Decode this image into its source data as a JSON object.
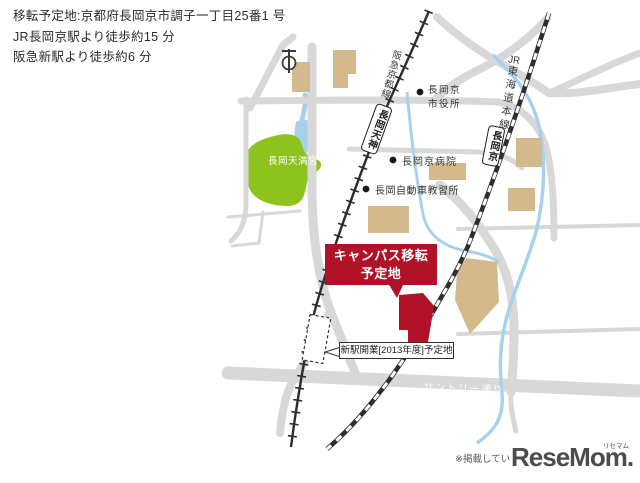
{
  "header": {
    "line1": "移転予定地:京都府長岡京市調子一丁目25番1 号",
    "line2": "JR長岡京駅より徒歩約15 分",
    "line3": "阪急新駅より徒歩約6 分"
  },
  "map": {
    "hankyu_line_label": "阪急京都線",
    "jr_line_label": {
      "prefix": "JR",
      "rest": "東海道本線"
    },
    "stations": {
      "hankyu": "長岡天神",
      "jr": "長岡京"
    },
    "park_label": "長岡天満宮",
    "city_hall": {
      "line1": "長岡京",
      "line2": "市役所"
    },
    "hospital_label": "長岡京病院",
    "driving_school_label": "長岡自動車教習所",
    "callout": {
      "line1": "キャンパス移転",
      "line2": "予定地"
    },
    "new_station_label": "新駅開業[2013年度]予定地",
    "road_label": "サントリー通り"
  },
  "footer": {
    "note": "※掲載してい",
    "logo_text": "ReseMom.",
    "logo_ruby": "リセマム"
  },
  "colors": {
    "site_red": "#b01229",
    "park_green": "#8ec31f",
    "building_beige": "#d4b98c",
    "road_gray": "#d8d8d8",
    "water_blue": "#a8d1ee",
    "rail_black": "#2d2d2d"
  }
}
